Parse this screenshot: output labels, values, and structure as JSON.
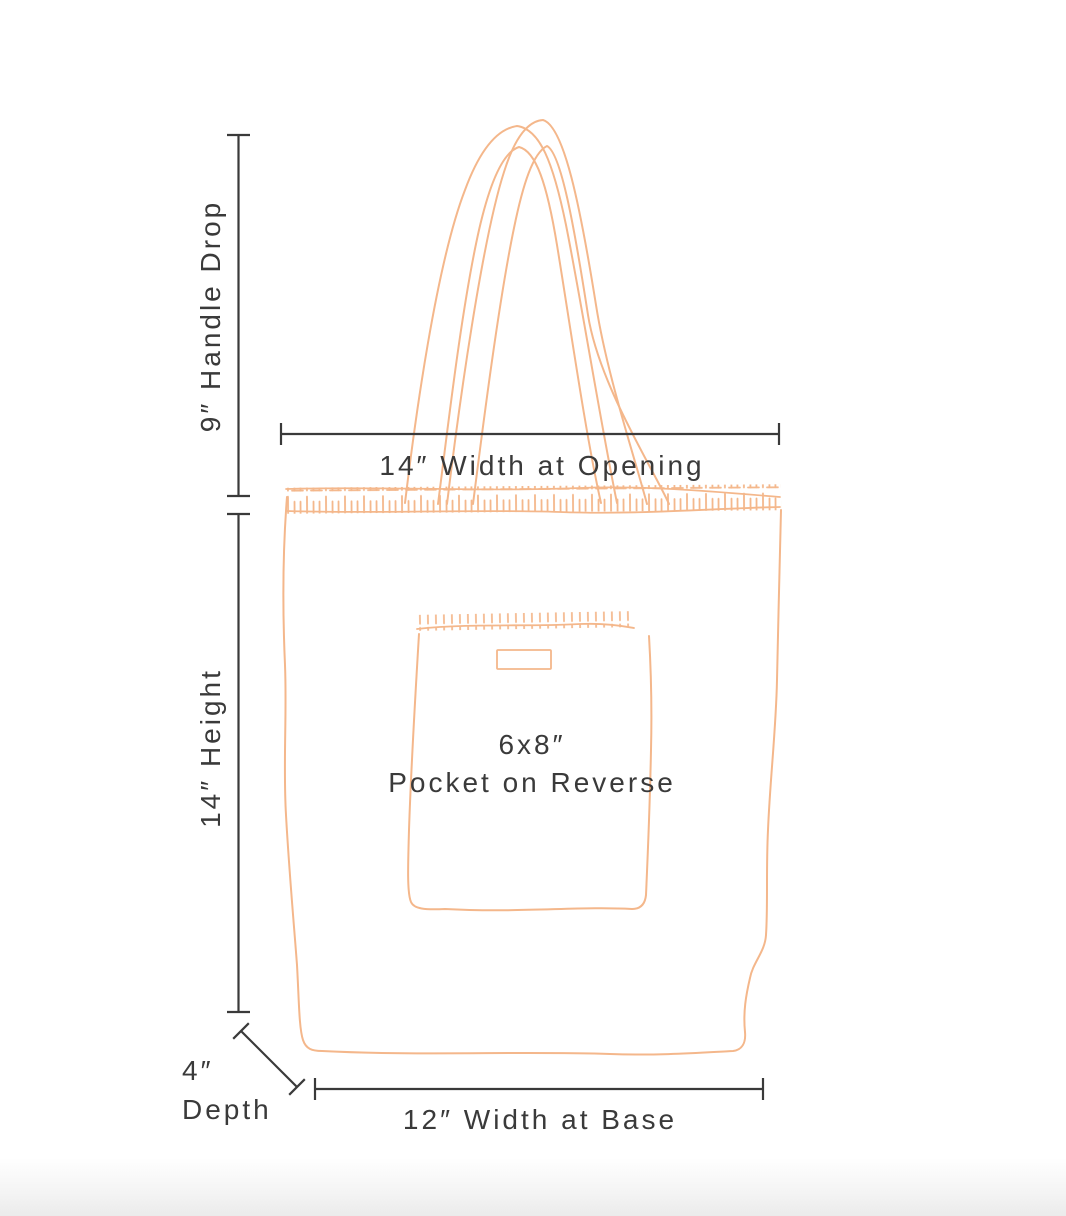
{
  "colors": {
    "outline": "#f4b78b",
    "stitch_light": "#f7cfb0",
    "ink": "#3a3a3a",
    "background": "#ffffff",
    "bottom_fade": "#ebebeb"
  },
  "labels": {
    "handle_drop": "9″ Handle Drop",
    "width_at_opening": "14″ Width at Opening",
    "height": "14″ Height",
    "pocket_size": "6x8″",
    "pocket_caption": "Pocket on Reverse",
    "depth_value": "4″",
    "depth_caption": "Depth",
    "width_at_base": "12″ Width at Base"
  },
  "measurements": [
    {
      "name": "handle-drop",
      "value": "9″"
    },
    {
      "name": "width-at-opening",
      "value": "14″"
    },
    {
      "name": "height",
      "value": "14″"
    },
    {
      "name": "pocket",
      "value": "6x8″",
      "note": "Pocket on Reverse"
    },
    {
      "name": "depth",
      "value": "4″"
    },
    {
      "name": "width-at-base",
      "value": "12″"
    }
  ]
}
